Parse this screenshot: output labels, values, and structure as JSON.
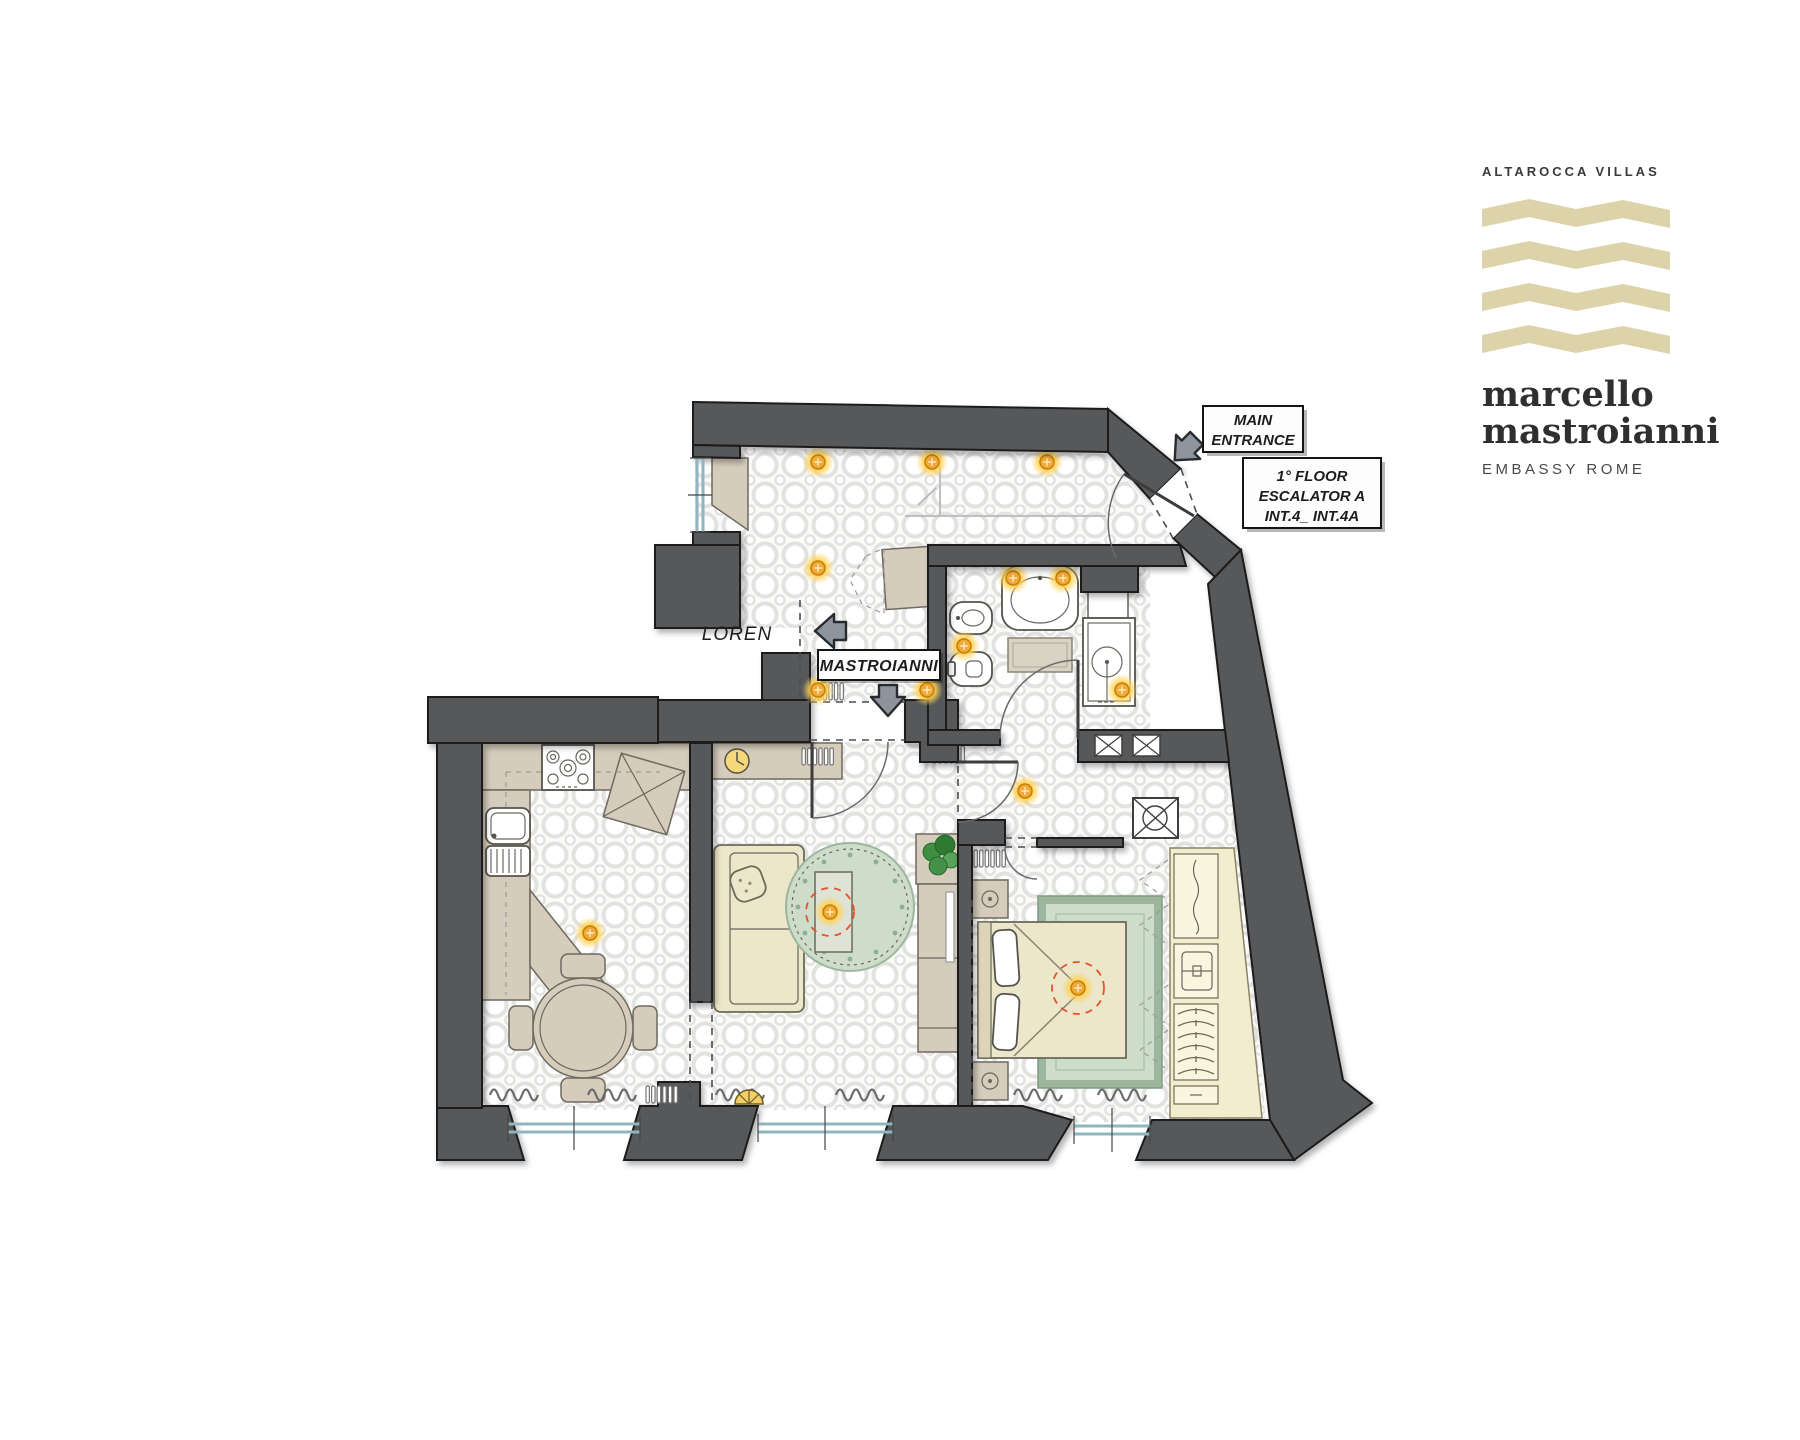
{
  "brand": {
    "name": "ALTAROCCA VILLAS",
    "title_line1": "marcello",
    "title_line2": "mastroianni",
    "subtitle": "EMBASSY ROME"
  },
  "labels": {
    "main_entrance": {
      "line1": "MAIN",
      "line2": "ENTRANCE"
    },
    "floor_info": {
      "line1": "1° FLOOR",
      "line2": "ESCALATOR A",
      "line3": "INT.4_ INT.4A"
    },
    "neighbor_unit": "LOREN",
    "unit_name": "MASTROIANNI"
  },
  "colors": {
    "wall": "#57585a",
    "wall-stroke": "#1b1b1b",
    "logo-wave": "#ddd3ab",
    "logo-text": "#333336",
    "tile-line": "#e2e2e1",
    "counter": "#d5ccbc",
    "furniture-cream": "#ece6ca",
    "wardrobe": "#f3edcf",
    "rug-green": "#cdddc9",
    "rug-border": "#9cb79d",
    "light-core": "#f2a93b",
    "pendant-ring": "#e2542c",
    "glazing": "#8fb6bf",
    "arrow": "#8d949c",
    "label-ink": "#1d1d1f"
  }
}
